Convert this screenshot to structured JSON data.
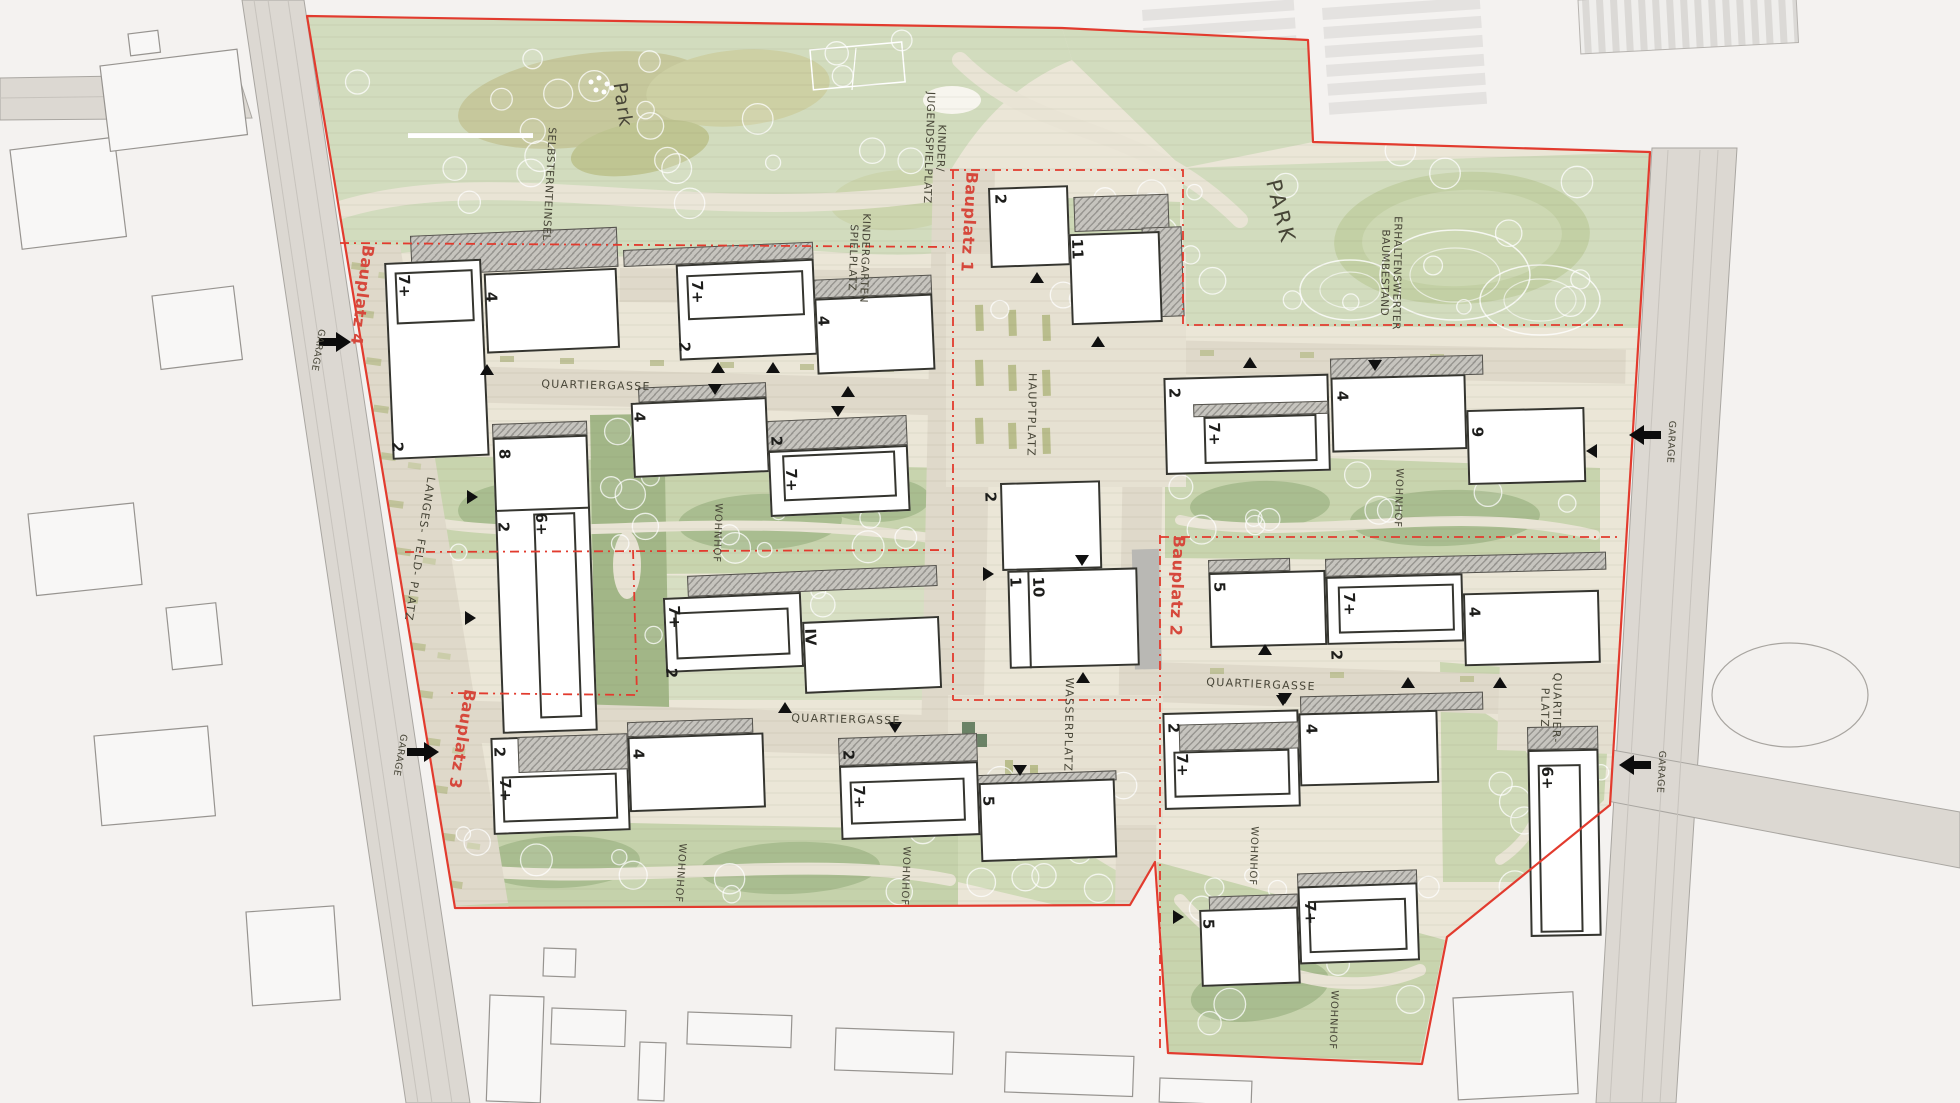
{
  "plan": {
    "colors": {
      "site_base": "#ebe6d7",
      "park_green": "#d2dcbe",
      "courtyard_green": "#c8d4ae",
      "dark_tree_green": "#a2b687",
      "olive": "#c6c89c",
      "street": "#dfd9ca",
      "building_outline": "#35352f",
      "boundary_red": "#e23b2e",
      "bauplatz_red": "#d6483c",
      "road_gray": "#dcd8d2",
      "context_bg": "#f4f2f0"
    },
    "site_outline": "307,16 1062,28 1308,40 1313,142 1650,152 1610,805 1447,937 1422,1064 1168,1053 1155,862 1130,905 455,908",
    "bauplatz_labels": [
      {
        "text": "Bauplatz 1",
        "x": 969,
        "y": 222,
        "rot": 93
      },
      {
        "text": "Bauplatz 2",
        "x": 1177,
        "y": 586,
        "rot": 92
      },
      {
        "text": "Bauplatz 3",
        "x": 462,
        "y": 739,
        "rot": 99
      },
      {
        "text": "Bauplatz 4",
        "x": 362,
        "y": 295,
        "rot": 97
      }
    ],
    "area_labels": [
      {
        "text": "Park",
        "x": 622,
        "y": 105,
        "rot": 82,
        "cls": "lbl-park"
      },
      {
        "text": "PARK",
        "x": 1280,
        "y": 212,
        "rot": 76,
        "cls": "lbl-PARK"
      },
      {
        "text": "SELBSTERNTEINSEL",
        "x": 548,
        "y": 184,
        "rot": 93,
        "cls": "lbl-area"
      },
      {
        "text": "KINDER/\nJUGENDSPIELPLATZ",
        "x": 934,
        "y": 148,
        "rot": 92,
        "cls": "lbl-area"
      },
      {
        "text": "KINDERGARTEN\nSPIELPLATZ",
        "x": 858,
        "y": 258,
        "rot": 92,
        "cls": "lbl-area"
      },
      {
        "text": "ERHALTENSWERTER\nBAUMBESTAND",
        "x": 1390,
        "y": 273,
        "rot": 91,
        "cls": "lbl-area"
      }
    ],
    "street_labels": [
      {
        "text": "QUARTIERGASSE",
        "x": 596,
        "y": 386,
        "rot": 1.5
      },
      {
        "text": "QUARTIERGASSE",
        "x": 846,
        "y": 720,
        "rot": 1.5
      },
      {
        "text": "QUARTIERGASSE",
        "x": 1261,
        "y": 685,
        "rot": 2.5
      },
      {
        "text": "HAUPTPLATZ",
        "x": 1031,
        "y": 415,
        "rot": 91
      },
      {
        "text": "WASSERPLATZ",
        "x": 1068,
        "y": 725,
        "rot": 91
      },
      {
        "text": "LANGES- FELD- PLATZ",
        "x": 419,
        "y": 549,
        "rot": 99
      },
      {
        "text": "QUARTIER-\nPLATZ",
        "x": 1550,
        "y": 708,
        "rot": 91
      }
    ],
    "wohnhof_labels": [
      {
        "text": "WOHNHOF",
        "x": 717,
        "y": 533,
        "rot": 92
      },
      {
        "text": "WOHNHOF",
        "x": 1398,
        "y": 498,
        "rot": 92
      },
      {
        "text": "WOHNHOF",
        "x": 680,
        "y": 873,
        "rot": 94
      },
      {
        "text": "WOHNHOF",
        "x": 905,
        "y": 876,
        "rot": 92
      },
      {
        "text": "WOHNHOF",
        "x": 1253,
        "y": 856,
        "rot": 92
      },
      {
        "text": "WOHNHOF",
        "x": 1333,
        "y": 1020,
        "rot": 92
      }
    ],
    "garage_markers": [
      {
        "text": "GARAGE",
        "x": 317,
        "y": 350,
        "rot": 100,
        "ax": 336,
        "ay": 342,
        "dir": "r"
      },
      {
        "text": "GARAGE",
        "x": 399,
        "y": 755,
        "rot": 100,
        "ax": 424,
        "ay": 752,
        "dir": "r"
      },
      {
        "text": "GARAGE",
        "x": 1670,
        "y": 442,
        "rot": 93,
        "ax": 1644,
        "ay": 435,
        "dir": "l"
      },
      {
        "text": "GARAGE",
        "x": 1660,
        "y": 772,
        "rot": 93,
        "ax": 1634,
        "ay": 765,
        "dir": "l"
      }
    ],
    "storey_labels": [
      {
        "t": "7+",
        "x": 404,
        "y": 286
      },
      {
        "t": "7+",
        "x": 697,
        "y": 292
      },
      {
        "t": "7+",
        "x": 791,
        "y": 480
      },
      {
        "t": "7+",
        "x": 674,
        "y": 617
      },
      {
        "t": "7+",
        "x": 505,
        "y": 790
      },
      {
        "t": "7+",
        "x": 859,
        "y": 797
      },
      {
        "t": "7+",
        "x": 1214,
        "y": 434
      },
      {
        "t": "7+",
        "x": 1349,
        "y": 604
      },
      {
        "t": "7+",
        "x": 1182,
        "y": 765
      },
      {
        "t": "7+",
        "x": 1310,
        "y": 913
      },
      {
        "t": "2",
        "x": 397,
        "y": 447
      },
      {
        "t": "2",
        "x": 684,
        "y": 347
      },
      {
        "t": "2",
        "x": 1000,
        "y": 199
      },
      {
        "t": "2",
        "x": 776,
        "y": 441
      },
      {
        "t": "2",
        "x": 671,
        "y": 673
      },
      {
        "t": "2",
        "x": 503,
        "y": 527
      },
      {
        "t": "2",
        "x": 499,
        "y": 752
      },
      {
        "t": "2",
        "x": 848,
        "y": 755
      },
      {
        "t": "2",
        "x": 1174,
        "y": 393
      },
      {
        "t": "2",
        "x": 1336,
        "y": 655
      },
      {
        "t": "2",
        "x": 1173,
        "y": 728
      },
      {
        "t": "2",
        "x": 990,
        "y": 497
      },
      {
        "t": "4",
        "x": 491,
        "y": 297
      },
      {
        "t": "4",
        "x": 823,
        "y": 321
      },
      {
        "t": "4",
        "x": 639,
        "y": 417
      },
      {
        "t": "4",
        "x": 638,
        "y": 754
      },
      {
        "t": "4",
        "x": 1342,
        "y": 396
      },
      {
        "t": "4",
        "x": 1474,
        "y": 612
      },
      {
        "t": "4",
        "x": 1311,
        "y": 729
      },
      {
        "t": "5",
        "x": 988,
        "y": 801
      },
      {
        "t": "5",
        "x": 1219,
        "y": 587
      },
      {
        "t": "5",
        "x": 1208,
        "y": 924
      },
      {
        "t": "6+",
        "x": 541,
        "y": 524
      },
      {
        "t": "6+",
        "x": 1547,
        "y": 778
      },
      {
        "t": "8",
        "x": 504,
        "y": 454
      },
      {
        "t": "9",
        "x": 1477,
        "y": 432
      },
      {
        "t": "10",
        "x": 1038,
        "y": 587
      },
      {
        "t": "1",
        "x": 1015,
        "y": 582
      },
      {
        "t": "11",
        "x": 1077,
        "y": 249
      },
      {
        "t": "IV",
        "x": 810,
        "y": 637
      }
    ],
    "blocks": [
      {
        "name": "block-bauplatz4-nw",
        "x": 383,
        "y": 237,
        "rot": -2.5,
        "parts": [
          {
            "k": "hatch",
            "x": 27,
            "y": 0,
            "w": 207,
            "h": 40
          },
          {
            "k": "white",
            "x": 0,
            "y": 26,
            "w": 97,
            "h": 197
          },
          {
            "k": "white",
            "x": 99,
            "y": 41,
            "w": 133,
            "h": 80
          },
          {
            "k": "inner",
            "x": 10,
            "y": 36,
            "w": 78,
            "h": 52
          }
        ]
      },
      {
        "name": "block-bauplatz4-n",
        "x": 623,
        "y": 250,
        "rot": -2.5,
        "parts": [
          {
            "k": "hatch",
            "x": 0,
            "y": 0,
            "w": 190,
            "h": 17
          },
          {
            "k": "hatch",
            "x": 189,
            "y": 38,
            "w": 118,
            "h": 19
          },
          {
            "k": "white",
            "x": 52,
            "y": 17,
            "w": 138,
            "h": 96
          },
          {
            "k": "white",
            "x": 189,
            "y": 57,
            "w": 118,
            "h": 76
          },
          {
            "k": "inner",
            "x": 62,
            "y": 28,
            "w": 117,
            "h": 45
          }
        ]
      },
      {
        "name": "block-bauplatz1-n",
        "x": 988,
        "y": 188,
        "rot": -2,
        "parts": [
          {
            "k": "hatch",
            "x": 85,
            "y": 12,
            "w": 95,
            "h": 35
          },
          {
            "k": "hatch",
            "x": 152,
            "y": 45,
            "w": 40,
            "h": 90
          },
          {
            "k": "white",
            "x": 0,
            "y": 0,
            "w": 80,
            "h": 80
          },
          {
            "k": "white",
            "x": 79,
            "y": 49,
            "w": 91,
            "h": 91
          }
        ]
      },
      {
        "name": "block-center-west",
        "x": 630,
        "y": 388,
        "rot": -2.5,
        "parts": [
          {
            "k": "hatch",
            "x": 8,
            "y": 0,
            "w": 128,
            "h": 15
          },
          {
            "k": "hatch",
            "x": 135,
            "y": 39,
            "w": 140,
            "h": 30
          },
          {
            "k": "white",
            "x": 0,
            "y": 15,
            "w": 136,
            "h": 75
          },
          {
            "k": "white",
            "x": 135,
            "y": 69,
            "w": 140,
            "h": 66
          },
          {
            "k": "inner",
            "x": 149,
            "y": 74,
            "w": 113,
            "h": 46
          }
        ]
      },
      {
        "name": "block-center-south",
        "x": 662,
        "y": 577,
        "rot": -2.5,
        "parts": [
          {
            "k": "hatch",
            "x": 25,
            "y": 0,
            "w": 250,
            "h": 21
          },
          {
            "k": "white",
            "x": 0,
            "y": 21,
            "w": 138,
            "h": 75
          },
          {
            "k": "white",
            "x": 138,
            "y": 51,
            "w": 137,
            "h": 72
          },
          {
            "k": "inner",
            "x": 11,
            "y": 36,
            "w": 114,
            "h": 47
          }
        ]
      },
      {
        "name": "block-west-slab",
        "x": 492,
        "y": 424,
        "rot": -2,
        "parts": [
          {
            "k": "hatch",
            "x": 0,
            "y": 0,
            "w": 95,
            "h": 14
          },
          {
            "k": "white",
            "x": 0,
            "y": 14,
            "w": 95,
            "h": 296
          },
          {
            "k": "line",
            "x": 0,
            "y": 86,
            "w": 95,
            "h": 2
          },
          {
            "k": "inner",
            "x": 38,
            "y": 91,
            "w": 42,
            "h": 205
          }
        ]
      },
      {
        "name": "block-bauplatz3-w",
        "x": 490,
        "y": 727,
        "rot": -2,
        "parts": [
          {
            "k": "white",
            "x": 0,
            "y": 11,
            "w": 137,
            "h": 97
          },
          {
            "k": "hatch",
            "x": 27,
            "y": 11,
            "w": 110,
            "h": 36
          },
          {
            "k": "hatch",
            "x": 137,
            "y": 0,
            "w": 126,
            "h": 15
          },
          {
            "k": "white",
            "x": 137,
            "y": 15,
            "w": 136,
            "h": 75
          },
          {
            "k": "inner",
            "x": 10,
            "y": 50,
            "w": 115,
            "h": 46
          }
        ]
      },
      {
        "name": "block-south-center",
        "x": 838,
        "y": 738,
        "rot": -2,
        "parts": [
          {
            "k": "hatch",
            "x": 0,
            "y": 0,
            "w": 139,
            "h": 28
          },
          {
            "k": "hatch",
            "x": 134,
            "y": 42,
            "w": 143,
            "h": 10
          },
          {
            "k": "white",
            "x": 0,
            "y": 28,
            "w": 139,
            "h": 74
          },
          {
            "k": "white",
            "x": 139,
            "y": 50,
            "w": 136,
            "h": 79
          },
          {
            "k": "inner",
            "x": 10,
            "y": 44,
            "w": 115,
            "h": 43
          }
        ]
      },
      {
        "name": "block-bauplatz2-n",
        "x": 1163,
        "y": 363,
        "rot": -1.5,
        "parts": [
          {
            "k": "hatch",
            "x": 167,
            "y": 0,
            "w": 153,
            "h": 20
          },
          {
            "k": "white",
            "x": 0,
            "y": 15,
            "w": 165,
            "h": 97
          },
          {
            "k": "hatch",
            "x": 29,
            "y": 42,
            "w": 135,
            "h": 13
          },
          {
            "k": "inner",
            "x": 39,
            "y": 55,
            "w": 113,
            "h": 47
          },
          {
            "k": "white",
            "x": 167,
            "y": 19,
            "w": 135,
            "h": 75
          },
          {
            "k": "white",
            "x": 302,
            "y": 55,
            "w": 118,
            "h": 75
          }
        ]
      },
      {
        "name": "block-bauplatz2-mid",
        "x": 1208,
        "y": 560,
        "rot": -1.5,
        "parts": [
          {
            "k": "hatch",
            "x": 0,
            "y": 0,
            "w": 82,
            "h": 13
          },
          {
            "k": "hatch",
            "x": 117,
            "y": 2,
            "w": 281,
            "h": 18
          },
          {
            "k": "white",
            "x": 0,
            "y": 13,
            "w": 117,
            "h": 75
          },
          {
            "k": "white",
            "x": 117,
            "y": 20,
            "w": 137,
            "h": 68
          },
          {
            "k": "inner",
            "x": 129,
            "y": 30,
            "w": 116,
            "h": 47
          },
          {
            "k": "white",
            "x": 254,
            "y": 40,
            "w": 136,
            "h": 73
          }
        ]
      },
      {
        "name": "block-bauplatz2-s",
        "x": 1162,
        "y": 700,
        "rot": -1.5,
        "parts": [
          {
            "k": "hatch",
            "x": 138,
            "y": 0,
            "w": 183,
            "h": 18
          },
          {
            "k": "white",
            "x": 0,
            "y": 13,
            "w": 136,
            "h": 97
          },
          {
            "k": "hatch",
            "x": 16,
            "y": 25,
            "w": 120,
            "h": 27
          },
          {
            "k": "inner",
            "x": 10,
            "y": 52,
            "w": 116,
            "h": 46
          },
          {
            "k": "white",
            "x": 136,
            "y": 17,
            "w": 139,
            "h": 73
          }
        ]
      },
      {
        "name": "block-bauplatz2-sw",
        "x": 1198,
        "y": 877,
        "rot": -2,
        "parts": [
          {
            "k": "hatch",
            "x": 10,
            "y": 20,
            "w": 89,
            "h": 15
          },
          {
            "k": "hatch",
            "x": 99,
            "y": 0,
            "w": 120,
            "h": 15
          },
          {
            "k": "white",
            "x": 0,
            "y": 33,
            "w": 99,
            "h": 77
          },
          {
            "k": "white",
            "x": 99,
            "y": 13,
            "w": 120,
            "h": 78
          },
          {
            "k": "inner",
            "x": 109,
            "y": 28,
            "w": 98,
            "h": 52
          }
        ]
      },
      {
        "name": "block-quartierplatz-tower",
        "x": 1527,
        "y": 727,
        "rot": -1,
        "parts": [
          {
            "k": "hatch",
            "x": 0,
            "y": 0,
            "w": 71,
            "h": 23
          },
          {
            "k": "white",
            "x": 0,
            "y": 23,
            "w": 71,
            "h": 187
          },
          {
            "k": "inner",
            "x": 10,
            "y": 38,
            "w": 43,
            "h": 168
          }
        ]
      },
      {
        "name": "block-hauptplatz-s",
        "x": 1000,
        "y": 483,
        "rot": -1.5,
        "parts": [
          {
            "k": "shadow",
            "x": 27,
            "y": 54,
            "w": 58,
            "h": 33
          },
          {
            "k": "shadow",
            "x": 130,
            "y": 70,
            "w": 27,
            "h": 120
          },
          {
            "k": "white",
            "x": 0,
            "y": 0,
            "w": 100,
            "h": 88
          },
          {
            "k": "white",
            "x": 5,
            "y": 88,
            "w": 130,
            "h": 98
          },
          {
            "k": "line",
            "x": 25,
            "y": 88,
            "w": 2,
            "h": 98
          }
        ]
      }
    ],
    "entrance_arrows": [
      {
        "x": 1037,
        "y": 278,
        "d": "u"
      },
      {
        "x": 1098,
        "y": 342,
        "d": "u"
      },
      {
        "x": 487,
        "y": 370,
        "d": "u"
      },
      {
        "x": 718,
        "y": 368,
        "d": "u"
      },
      {
        "x": 773,
        "y": 368,
        "d": "u"
      },
      {
        "x": 715,
        "y": 389,
        "d": "d"
      },
      {
        "x": 848,
        "y": 392,
        "d": "u"
      },
      {
        "x": 838,
        "y": 411,
        "d": "d"
      },
      {
        "x": 1250,
        "y": 363,
        "d": "u"
      },
      {
        "x": 1375,
        "y": 365,
        "d": "d"
      },
      {
        "x": 472,
        "y": 497,
        "d": "r"
      },
      {
        "x": 470,
        "y": 618,
        "d": "r"
      },
      {
        "x": 1082,
        "y": 560,
        "d": "d"
      },
      {
        "x": 988,
        "y": 574,
        "d": "r"
      },
      {
        "x": 1592,
        "y": 451,
        "d": "l"
      },
      {
        "x": 1083,
        "y": 678,
        "d": "u"
      },
      {
        "x": 1265,
        "y": 650,
        "d": "u"
      },
      {
        "x": 1285,
        "y": 698,
        "d": "d"
      },
      {
        "x": 1408,
        "y": 683,
        "d": "u"
      },
      {
        "x": 1500,
        "y": 683,
        "d": "u"
      },
      {
        "x": 1283,
        "y": 700,
        "d": "d"
      },
      {
        "x": 785,
        "y": 708,
        "d": "u"
      },
      {
        "x": 895,
        "y": 727,
        "d": "d"
      },
      {
        "x": 1020,
        "y": 770,
        "d": "d"
      },
      {
        "x": 1178,
        "y": 917,
        "d": "r"
      }
    ],
    "dashed_boundaries": [
      "340,243 950,247",
      "953,170 953,700",
      "950,170 1183,170 1183,325 1625,325",
      "405,552 950,550",
      "633,550 637,695 448,693",
      "953,700 1157,700",
      "1160,535 1160,1050",
      "1160,537 1620,537"
    ]
  }
}
